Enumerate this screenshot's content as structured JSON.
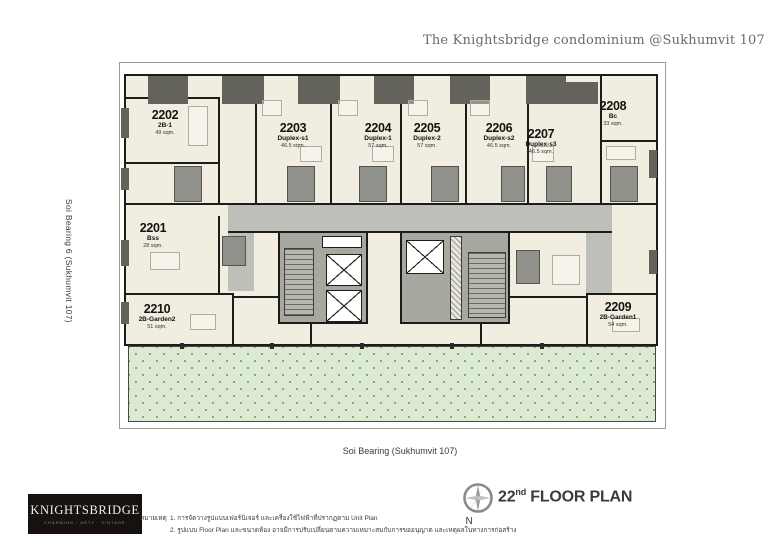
{
  "header": {
    "title": "The Knightsbridge condominium @Sukhumvit 107"
  },
  "streets": {
    "left": "Soi Bearing 6 (Sukhumvit 107)",
    "bottom": "Soi Bearing (Sukhumvit 107)"
  },
  "units": [
    {
      "number": "2201",
      "type": "Bss",
      "area": "28 sqm."
    },
    {
      "number": "2202",
      "type": "2B-1",
      "area": "49 sqm."
    },
    {
      "number": "2203",
      "type": "Duplex-s1",
      "area": "46.5 sqm."
    },
    {
      "number": "2204",
      "type": "Duplex-1",
      "area": "57 sqm."
    },
    {
      "number": "2205",
      "type": "Duplex-2",
      "area": "57 sqm."
    },
    {
      "number": "2206",
      "type": "Duplex-s2",
      "area": "46.5 sqm."
    },
    {
      "number": "2207",
      "type": "Duplex-s3",
      "area": "46.5 sqm."
    },
    {
      "number": "2208",
      "type": "Bc",
      "area": "33 sqm."
    },
    {
      "number": "2209",
      "type": "2B-Garden1",
      "area": "54 sqm."
    },
    {
      "number": "2210",
      "type": "2B-Garden2",
      "area": "51 sqm."
    }
  ],
  "title_block": {
    "floor_number": "22",
    "floor_ordinal": "nd",
    "floor_label": "FLOOR PLAN",
    "compass_north": "N"
  },
  "logo": {
    "name": "KNIGHTSBRIDGE",
    "tagline": "CHARMING · ARTY · VINTAGE"
  },
  "notes": {
    "heading": "หมายเหตุ",
    "line1": "1. การจัดวางรูปแบบเฟอร์นิเจอร์ และเครื่องใช้ไฟฟ้าที่ปรากฏตาม Unit Plan",
    "line2": "2. รูปแบบ Floor Plan และขนาดห้อง อาจมีการปรับเปลี่ยนตามความเหมาะสมกับการขออนุญาต และเหตุผลในทางการก่อสร้าง"
  },
  "colors": {
    "plan_cream": "#f1eee1",
    "wall_black": "#1c1c1a",
    "corridor_gray": "#bfbfba",
    "core_gray": "#a7a9a0",
    "dark_block": "#63635c",
    "garden_green": "#dcead4",
    "garden_dot": "#6fa067",
    "compass_teal": "#4d99a4",
    "logo_bg": "#171110"
  }
}
